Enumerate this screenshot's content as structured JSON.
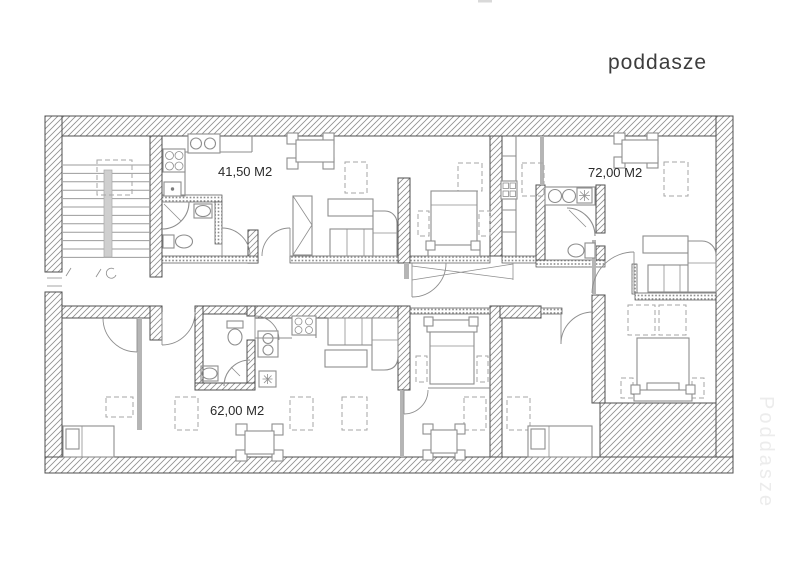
{
  "page": {
    "title_label": "poddasze",
    "watermark": "Poddasze",
    "background": "#ffffff"
  },
  "plan": {
    "area_labels": [
      {
        "id": "apartment-1",
        "text": "41,50 M2"
      },
      {
        "id": "apartment-2",
        "text": "72,00 M2"
      },
      {
        "id": "apartment-3",
        "text": "62,00 M2"
      }
    ],
    "colors": {
      "wall_line": "#4f4f4f",
      "hatch": "#8f8f8f",
      "furniture": "#8e8e8e",
      "dashed": "#a6a6a6",
      "thin_wall": "#b5b5b5",
      "label_text": "#2b2b2b",
      "title_text": "#3d3d3d",
      "watermark_text": "#ececec",
      "page_bg": "#ffffff"
    }
  }
}
